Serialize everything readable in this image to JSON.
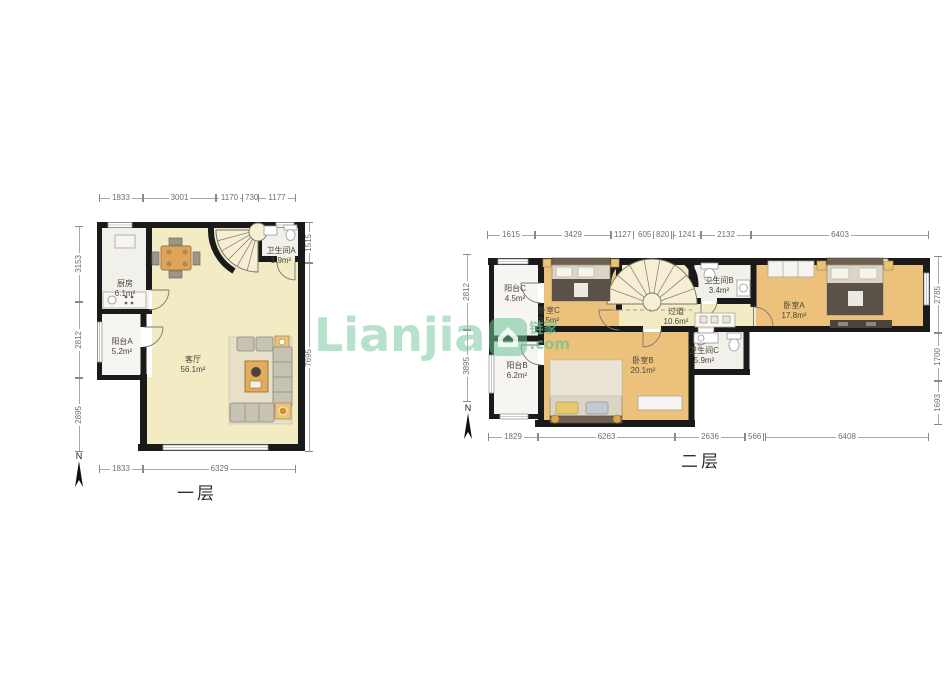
{
  "watermark": {
    "brand": "Lianjia",
    "cn": "链家",
    "domain": ".com",
    "accent_color": "#6fc79c"
  },
  "floor1": {
    "label": "一层",
    "north": "N",
    "rooms": {
      "kitchen": {
        "name": "厨房",
        "area": "6.1m²"
      },
      "bath_a": {
        "name": "卫生间A",
        "area": "1.9m²"
      },
      "living": {
        "name": "客厅",
        "area": "56.1m²"
      },
      "balcony_a": {
        "name": "阳台A",
        "area": "5.2m²"
      }
    },
    "dims_top": [
      "1833",
      "3001",
      "1170",
      "730",
      "1177"
    ],
    "dims_bottom": [
      "1833",
      "6329"
    ],
    "dims_left": [
      "3153",
      "2812",
      "2895"
    ],
    "dims_right": [
      "1515",
      "7695"
    ]
  },
  "floor2": {
    "label": "二层",
    "north": "N",
    "rooms": {
      "balcony_c": {
        "name": "阳台C",
        "area": "4.5m²"
      },
      "bed_c": {
        "name": "卧室C",
        "area": "9.5m²"
      },
      "bath_b": {
        "name": "卫生间B",
        "area": "3.4m²"
      },
      "bed_a": {
        "name": "卧室A",
        "area": "17.8m²"
      },
      "corridor": {
        "name": "过道",
        "area": "10.6m²"
      },
      "bath_c": {
        "name": "卫生间C",
        "area": "5.9m²"
      },
      "bed_b": {
        "name": "卧室B",
        "area": "20.1m²"
      },
      "balcony_b": {
        "name": "阳台B",
        "area": "6.2m²"
      }
    },
    "dims_top": [
      "1615",
      "3429",
      "1127",
      "605",
      "820",
      "1241",
      "2132",
      "6403"
    ],
    "dims_bottom": [
      "1829",
      "6263",
      "2636",
      "566",
      "6408"
    ],
    "dims_left": [
      "2812",
      "3895"
    ],
    "dims_right": [
      "2785",
      "1700",
      "1693"
    ]
  }
}
